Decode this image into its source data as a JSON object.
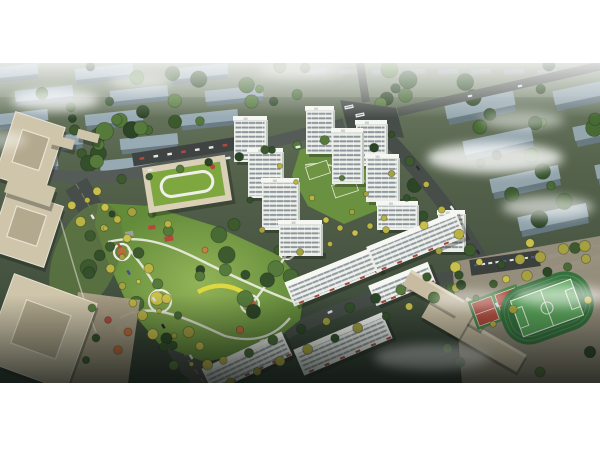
{
  "meta": {
    "description": "Aerial bird's-eye architectural rendering of a residential masterplan: white high-rise towers around a central landscaped park, tree-lined boulevard, kindergarten with green roof, office towers at left, school campus with sports field at lower right, hazy rows of slab buildings in the background",
    "width": 600,
    "height": 450,
    "frame": {
      "x": 0,
      "y": 63,
      "w": 600,
      "h": 320
    }
  },
  "palette": {
    "page_bg": "#ffffff",
    "haze_green": "#b9c4ae",
    "ground_top": "#74816b",
    "ground_mid1": "#57654e",
    "ground_mid2": "#43513f",
    "ground_bottom": "#2c372e",
    "bg_roof": "#a3b6c4",
    "bg_face": "#6d7f8e",
    "bg_roof_far": "#93a5b2",
    "tree_greens": [
      "#3d5a2e",
      "#486a35",
      "#557a3c",
      "#33502a",
      "#2c4526"
    ],
    "tree_yellows": [
      "#b9b244",
      "#c9c04c",
      "#a5a140"
    ],
    "tree_accents": [
      "#bf6a38",
      "#b5483c",
      "#c9803c"
    ],
    "road_dark": "#474d49",
    "road_mid": "#555b56",
    "road_line": "#7c8273",
    "park_light": "#93b358",
    "park_dark": "#628b3a",
    "path_white": "#edeee3",
    "accent_yellow": "#ddd83f",
    "tower_face": "#eceee9",
    "tower_stripe": "#7f8a91",
    "tower_side": "#c2c7c1",
    "tower_roof": "#f6f7f3",
    "office_beige": "#cfc5ab",
    "office_core": "#b3a98e",
    "office_rim": "#e9e3d2",
    "plaza": "#ab9f87",
    "school_wall": "#d9d0b7",
    "school_roof": "#7ea83f",
    "loop_white": "#eef0e8",
    "campus_ground": "#9a9180",
    "field_track": "#35713e",
    "field_pitch": "#57a257",
    "court_red": "#b04a3c",
    "court_green": "#49854a",
    "awning_red": "#a8453a",
    "fog": "#ffffff",
    "shadow": "rgba(18,24,18,0.32)"
  },
  "background": {
    "left_rows": [
      {
        "x": -20,
        "y": 66,
        "count": 3,
        "dx": 95
      },
      {
        "x": 15,
        "y": 88,
        "count": 3,
        "dx": 95
      },
      {
        "x": -10,
        "y": 112,
        "count": 3,
        "dx": 95
      },
      {
        "x": 25,
        "y": 136,
        "count": 2,
        "dx": 95
      },
      {
        "x": 0,
        "y": 158,
        "count": 2,
        "dx": 100
      }
    ],
    "left_slab": {
      "w": 58,
      "h": 11,
      "angle": -6
    },
    "right_slabs": [
      [
        445,
        98
      ],
      [
        553,
        84
      ],
      [
        463,
        134
      ],
      [
        573,
        120
      ],
      [
        490,
        172
      ],
      [
        595,
        158
      ],
      [
        518,
        210
      ],
      [
        548,
        248
      ]
    ],
    "right_slab": {
      "w": 70,
      "h": 14,
      "angle": -12
    },
    "far_houses": {
      "x0": 306,
      "y": 70,
      "count": 9,
      "dx": 33,
      "w": 20,
      "h": 5,
      "angle": -4
    },
    "tree_regions": [
      {
        "x0": 0,
        "x1": 235,
        "y0": 64,
        "y1": 170,
        "n": 26
      },
      {
        "x0": 395,
        "x1": 600,
        "y0": 64,
        "y1": 250,
        "n": 24
      },
      {
        "x0": 238,
        "x1": 392,
        "y0": 64,
        "y1": 104,
        "n": 10
      },
      {
        "x0": 432,
        "x1": 600,
        "y0": 258,
        "y1": 380,
        "n": 10
      }
    ]
  },
  "roads": {
    "segments": [
      {
        "name": "north-road",
        "d": "M -5,166 C 70,182 110,180 170,166 C 240,150 300,136 344,124",
        "w": 12,
        "tone": "mid"
      },
      {
        "name": "top-stub-road",
        "d": "M 360,63 L 366,102",
        "w": 8,
        "tone": "mid"
      },
      {
        "name": "northeast-road",
        "d": "M 398,112 L 600,66",
        "w": 9,
        "tone": "mid"
      },
      {
        "name": "east-road",
        "d": "M 372,122 C 412,162 452,210 480,258 C 500,294 510,338 516,383",
        "w": 14,
        "tone": "dark"
      },
      {
        "name": "campus-road",
        "d": "M 488,280 L 600,250",
        "w": 9,
        "tone": "mid"
      },
      {
        "name": "boulevard",
        "d": "M 76,184 C 108,238 158,316 204,383",
        "w": 25,
        "tone": "dark"
      },
      {
        "name": "commercial-street",
        "d": "M 206,383 C 252,344 318,314 398,291 C 434,281 462,274 490,268",
        "w": 13,
        "tone": "dark"
      }
    ],
    "median": "M 76,184 C 108,238 158,316 204,383",
    "intersection": "340,100 396,108 404,138 348,130"
  },
  "park": {
    "outline": "98,203 150,206 215,226 280,256 305,286 300,320 262,350 205,362 160,345 130,310 105,255 95,225",
    "paths": [
      "M 108,242 C 140,234 168,244 196,258 C 236,278 268,292 294,302",
      "M 120,318 C 150,300 185,318 225,336 C 255,344 275,336 290,318",
      "M 128,248 C 148,272 158,288 162,302",
      "M 250,306 C 265,288 278,268 288,252"
    ],
    "yellow_path": "M 198,292 C 214,283 230,284 244,293",
    "plazas": [
      {
        "cx": 122,
        "cy": 252,
        "r": 8,
        "inner": "#bf6a38"
      },
      {
        "cx": 160,
        "cy": 301,
        "r": 11,
        "inner": "#7fa04a"
      },
      {
        "cx": 250,
        "cy": 304,
        "r": 9,
        "inner": "#b05330"
      },
      {
        "cx": 287,
        "cy": 251,
        "r": 8,
        "inner": "#6f9242"
      }
    ],
    "pavilions": [
      [
        148,
        226,
        7,
        4
      ],
      [
        164,
        237,
        9,
        5
      ],
      [
        125,
        232,
        8,
        5
      ]
    ],
    "accent_trees": [
      [
        120,
        330
      ],
      [
        105,
        312
      ],
      [
        240,
        330
      ],
      [
        205,
        250
      ]
    ],
    "ellipse": {
      "cx": 190,
      "cy": 284,
      "rx": 108,
      "ry": 66
    },
    "tree_n": 30
  },
  "west_side": {
    "offices": [
      [
        30,
        152,
        52,
        68,
        18
      ],
      [
        26,
        228,
        58,
        64,
        18
      ],
      [
        40,
        332,
        88,
        92,
        20
      ]
    ],
    "north_blocks": [
      [
        62,
        142,
        24,
        10,
        15
      ],
      [
        88,
        136,
        22,
        9,
        15
      ]
    ],
    "court": [
      30,
      190,
      48,
      20,
      18
    ],
    "plaza_poly": "78,292 140,300 128,383 66,383",
    "plaza_trees": [
      [
        92,
        308
      ],
      [
        108,
        320
      ],
      [
        96,
        338
      ],
      [
        118,
        350
      ],
      [
        86,
        360
      ],
      [
        128,
        332
      ]
    ],
    "garden": {
      "cx": 86,
      "cy": 258,
      "rx": 32,
      "ry": 58,
      "rot": 22
    },
    "garden_trees": [
      [
        112,
        214
      ],
      [
        132,
        212
      ],
      [
        152,
        214
      ],
      [
        168,
        224
      ],
      [
        104,
        228
      ]
    ],
    "west_path": "M 58,212 C 70,252 80,292 96,332"
  },
  "complex": {
    "school": {
      "cx": 187,
      "cy": 184,
      "w": 84,
      "h": 46,
      "a": -9
    },
    "school_parking": {
      "cx": 195,
      "cy": 150,
      "w": 126,
      "h": 13,
      "a": -9,
      "cars": 8
    },
    "towers": [
      [
        234,
        118,
        32,
        44
      ],
      [
        248,
        150,
        34,
        48
      ],
      [
        262,
        180,
        36,
        50
      ],
      [
        279,
        222,
        42,
        34
      ],
      [
        306,
        108,
        27,
        46
      ],
      [
        332,
        130,
        30,
        54
      ],
      [
        356,
        122,
        30,
        44
      ],
      [
        366,
        156,
        32,
        46
      ],
      [
        377,
        203,
        40,
        27
      ],
      [
        438,
        212,
        26,
        40
      ]
    ],
    "inner_slabs": [
      {
        "cx": 333,
        "cy": 277,
        "w": 94,
        "h": 26,
        "a": -22,
        "awn": true
      },
      {
        "cx": 416,
        "cy": 242,
        "w": 96,
        "h": 28,
        "a": -22,
        "awn": true
      },
      {
        "cx": 402,
        "cy": 284,
        "w": 64,
        "h": 22,
        "a": -22,
        "awn": true
      }
    ],
    "outer_slabs": [
      {
        "cx": 247,
        "cy": 362,
        "w": 88,
        "h": 26,
        "a": -25,
        "awn": true
      },
      {
        "cx": 343,
        "cy": 344,
        "w": 96,
        "h": 28,
        "a": -23,
        "awn": true
      }
    ],
    "courtyard": "300,150 336,138 372,152 388,178 378,210 344,224 308,206 292,176",
    "green_roofs": [
      [
        318,
        170,
        22,
        13,
        -18
      ],
      [
        345,
        188,
        24,
        13,
        -18
      ]
    ],
    "roof_trees": [
      [
        340,
        228
      ],
      [
        355,
        233
      ],
      [
        370,
        226
      ],
      [
        384,
        218
      ],
      [
        326,
        220
      ]
    ],
    "base_bushes": [
      [
        280,
        166
      ],
      [
        296,
        182
      ],
      [
        312,
        198
      ],
      [
        272,
        150
      ],
      [
        342,
        178
      ],
      [
        300,
        252
      ],
      [
        366,
        194
      ],
      [
        352,
        212
      ],
      [
        386,
        230
      ],
      [
        330,
        244
      ],
      [
        250,
        200
      ],
      [
        262,
        230
      ]
    ]
  },
  "campus": {
    "ground": "452,262 600,236 600,383 462,383",
    "buildings": [
      [
        474,
        336,
        110,
        20,
        30
      ],
      [
        446,
        300,
        90,
        18,
        30
      ],
      [
        463,
        318,
        14,
        40,
        30
      ]
    ],
    "field": {
      "cx": 547,
      "cy": 308,
      "a": -20
    },
    "courts": {
      "cx": 497,
      "cy": 307,
      "a": -20
    },
    "parking": {
      "cx": 505,
      "cy": 263,
      "w": 70,
      "h": 16,
      "a": -8
    },
    "trees": [
      [
        470,
        250
      ],
      [
        530,
        243
      ],
      [
        575,
        248
      ],
      [
        456,
        288
      ],
      [
        460,
        362
      ],
      [
        540,
        372
      ],
      [
        590,
        352
      ],
      [
        588,
        300
      ]
    ]
  },
  "tree_lines": [
    {
      "x1": 78,
      "y1": 190,
      "x2": 202,
      "y2": 380,
      "n": 12,
      "off": 15,
      "sides": 2,
      "type": "mixed"
    },
    {
      "x1": 80,
      "y1": 188,
      "x2": 200,
      "y2": 378,
      "n": 7,
      "off": 0,
      "sides": 1,
      "type": "median"
    },
    {
      "x1": 214,
      "y1": 376,
      "x2": 470,
      "y2": 272,
      "n": 10,
      "off": 10,
      "sides": 2,
      "type": "mixed"
    },
    {
      "x1": 374,
      "y1": 130,
      "x2": 510,
      "y2": 330,
      "n": 8,
      "off": 12,
      "sides": 2,
      "type": "mixedG"
    },
    {
      "x1": 104,
      "y1": 176,
      "x2": 338,
      "y2": 128,
      "n": 8,
      "off": 8,
      "sides": 1,
      "type": "green"
    },
    {
      "x1": 492,
      "y1": 276,
      "x2": 596,
      "y2": 250,
      "n": 5,
      "off": 8,
      "sides": 2,
      "type": "mixed"
    }
  ],
  "clouds": [
    [
      55,
      100,
      44,
      11,
      0.7
    ],
    [
      140,
      82,
      30,
      8,
      0.45
    ],
    [
      300,
      71,
      42,
      8,
      0.4
    ],
    [
      495,
      158,
      68,
      15,
      0.8
    ],
    [
      548,
      207,
      46,
      11,
      0.6
    ],
    [
      562,
      296,
      48,
      11,
      0.55
    ],
    [
      432,
      358,
      58,
      13,
      0.6
    ],
    [
      522,
      120,
      42,
      9,
      0.5
    ],
    [
      -5,
      140,
      32,
      9,
      0.45
    ],
    [
      470,
      300,
      40,
      10,
      0.4
    ]
  ],
  "vehicles": {
    "boulevard": {
      "x1": 78,
      "y1": 188,
      "x2": 202,
      "y2": 380,
      "t": [
        0.15,
        0.3,
        0.44,
        0.58,
        0.72,
        0.88
      ],
      "ang": 57,
      "colors": [
        "#e8e8e6",
        "#b8493d",
        "#3d4f91",
        "#dcdcda",
        "#20242a",
        "#e8e8e6"
      ]
    },
    "north_cars": [
      [
        150,
        170
      ],
      [
        228,
        158
      ],
      [
        298,
        147
      ]
    ],
    "ne_cars": [
      [
        470,
        96
      ],
      [
        520,
        86
      ]
    ],
    "buses": [
      [
        349,
        107
      ],
      [
        360,
        115
      ]
    ],
    "east_cars": [
      [
        418,
        168
      ],
      [
        452,
        208
      ],
      [
        478,
        252
      ],
      [
        497,
        305
      ]
    ],
    "street_cars": [
      [
        262,
        341
      ],
      [
        330,
        312
      ]
    ]
  }
}
